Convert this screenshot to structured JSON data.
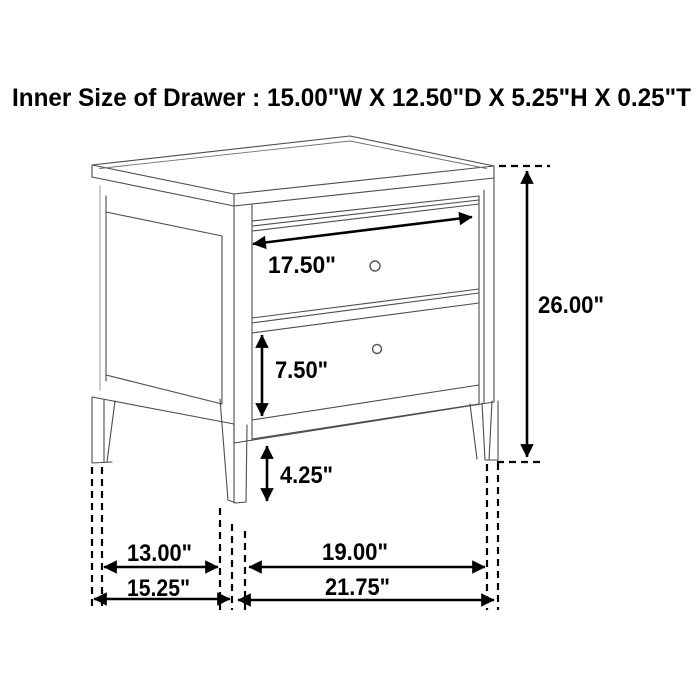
{
  "title": "Inner Size of Drawer : 15.00\"W X 12.50\"D X 5.25\"H X 0.25\"T",
  "inner_drawer_size": {
    "width": "15.00\"W",
    "depth": "12.50\"D",
    "height": "5.25\"H",
    "thickness": "0.25\"T"
  },
  "figure": {
    "item": "two-drawer nightstand dimension line drawing",
    "drawer_count": 2,
    "dimensions": {
      "drawer_front_width": {
        "label": "17.50\"",
        "value": 17.5,
        "unit": "in"
      },
      "overall_height": {
        "label": "26.00\"",
        "value": 26.0,
        "unit": "in"
      },
      "lower_drawer_height": {
        "label": "7.50\"",
        "value": 7.5,
        "unit": "in"
      },
      "leg_height": {
        "label": "4.25\"",
        "value": 4.25,
        "unit": "in"
      },
      "depth_between_legs": {
        "label": "13.00\"",
        "value": 13.0,
        "unit": "in"
      },
      "overall_depth": {
        "label": "15.25\"",
        "value": 15.25,
        "unit": "in"
      },
      "width_between_legs": {
        "label": "19.00\"",
        "value": 19.0,
        "unit": "in"
      },
      "overall_width": {
        "label": "21.75\"",
        "value": 21.75,
        "unit": "in"
      }
    }
  },
  "colors": {
    "background": "#ffffff",
    "furniture_line": "#4d4d4d",
    "dimension_line": "#000000"
  }
}
